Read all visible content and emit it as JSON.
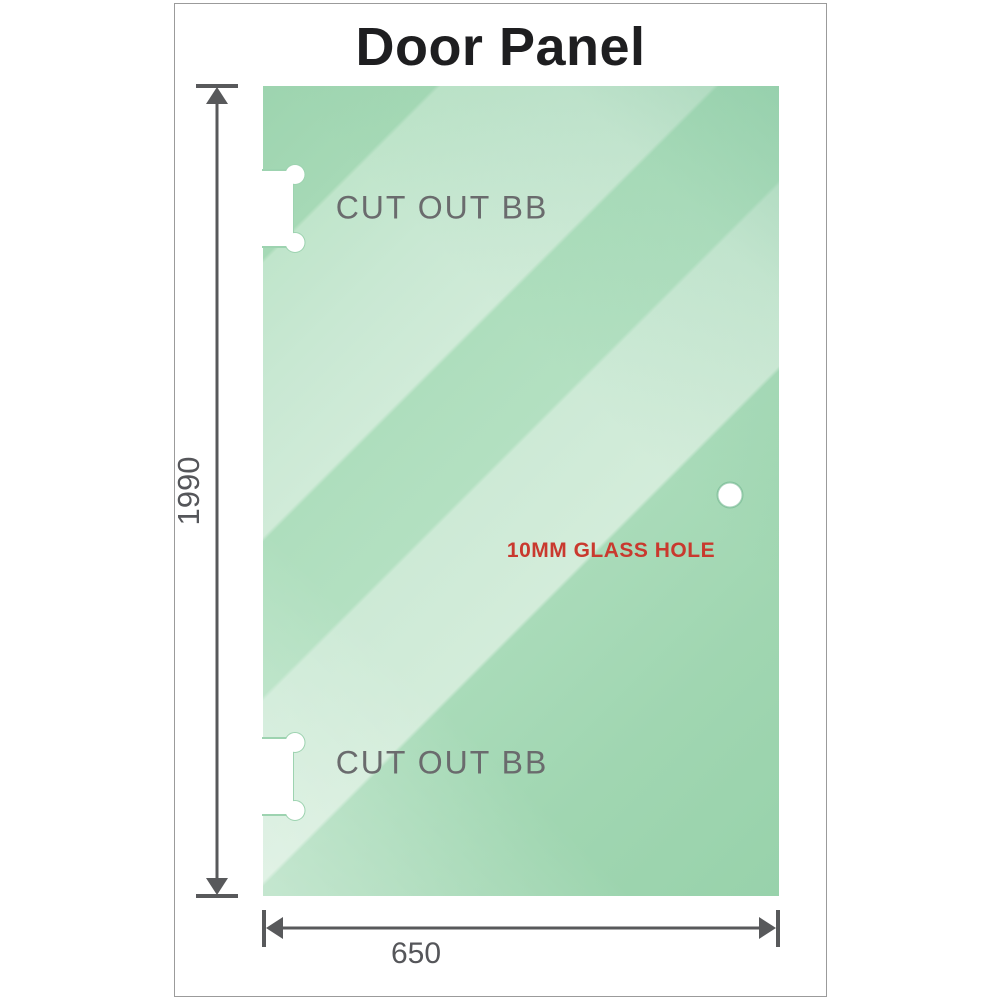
{
  "title": "Door Panel",
  "panel": {
    "cutout_top_label": "CUT OUT BB",
    "cutout_bottom_label": "CUT OUT BB",
    "hole_label": "10MM GLASS HOLE"
  },
  "dimensions": {
    "height_value": "1990",
    "width_value": "650"
  },
  "colors": {
    "glass_light": "#d0ebd8",
    "glass_medium": "#9dd4af",
    "dimension_gray": "#58595b",
    "cutout_label_gray": "#6a6b6d",
    "hole_label_red": "#c9392e",
    "frame_border_gray": "#9b9b9b",
    "title_black": "#1e1e20"
  }
}
